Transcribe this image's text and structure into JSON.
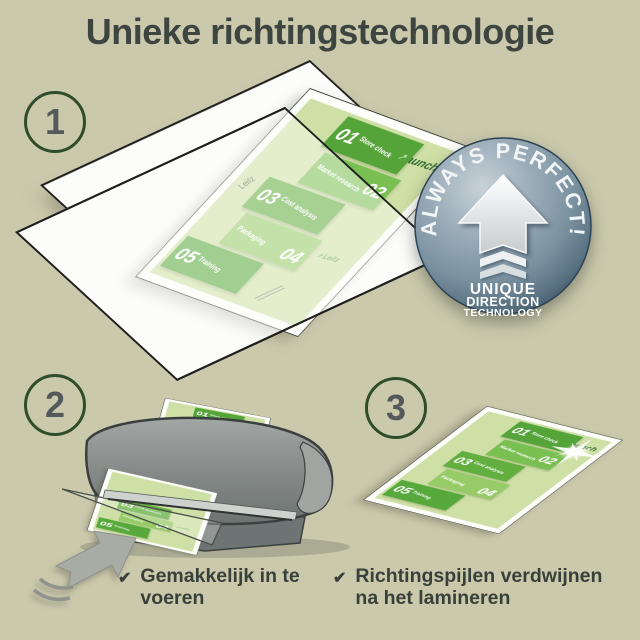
{
  "title": "Unieke richtingstechnologie",
  "steps": [
    {
      "number": "1"
    },
    {
      "number": "2"
    },
    {
      "number": "3"
    }
  ],
  "badge": {
    "arc_text": "ALWAYS PERFECT!",
    "lines": [
      "UNIQUE",
      "DIRECTION",
      "TECHNOLOGY"
    ]
  },
  "doc": {
    "launch": "Launch",
    "brand": "Leitz",
    "arrow_glyph": "↗",
    "items": [
      {
        "number": "01",
        "label": "Store check"
      },
      {
        "number": "02",
        "label": "Market research"
      },
      {
        "number": "03",
        "label": "Cost analysis"
      },
      {
        "number": "04",
        "label": "Packaging"
      },
      {
        "number": "05",
        "label": "Training"
      }
    ]
  },
  "captions": [
    {
      "icon": "✔",
      "text": "Gemakkelijk in te voeren"
    },
    {
      "icon": "✔",
      "text": "Richtingspijlen verdwijnen na het lamineren"
    }
  ],
  "colors": {
    "background": "#cac9ac",
    "title_text": "#3e4541",
    "accent_green": "#55a43a",
    "page_green": "#cfe0a6",
    "badge_blue": "#7b92a1",
    "machine_gray": "#8b908e",
    "arrow_gray": "#a9aba5",
    "circle_border": "#2f4d2b"
  }
}
